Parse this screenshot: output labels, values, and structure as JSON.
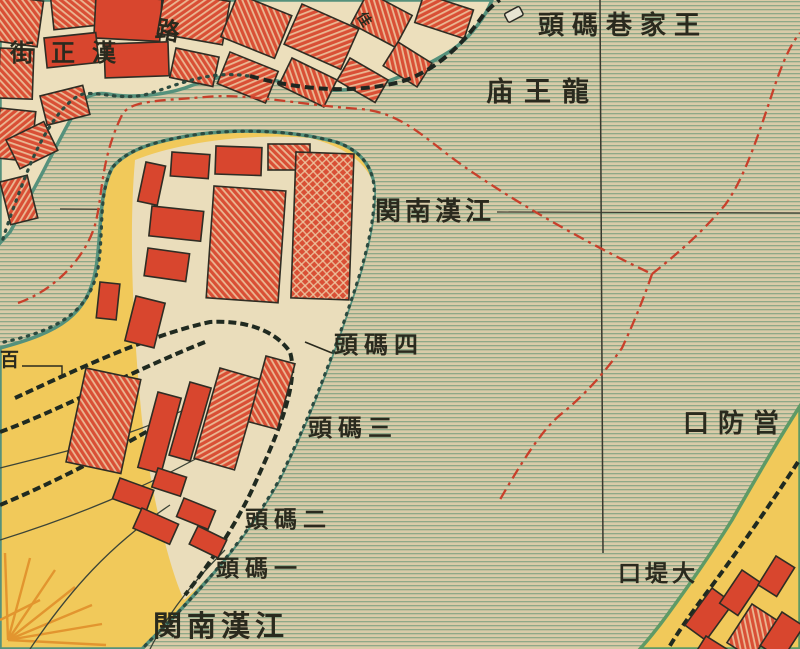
{
  "map": {
    "labels": {
      "wangjiaxiang_wharf": "頭碼巷家王",
      "longwang_temple": "庙王龍",
      "jianghan_nanguan_river": "関南漢江",
      "wharf_4": "頭碼四",
      "wharf_3": "頭碼三",
      "wharf_2": "頭碼二",
      "wharf_1": "頭碼一",
      "jianghan_nanguan_south": "関南漢江",
      "yingfangkou": "口防営",
      "dadikou": "口堤大",
      "hanzheng_street": "街正漢",
      "road_char": "路",
      "street_char": "佳",
      "bai_char": "百"
    },
    "colors": {
      "water_base": "#d9cba8",
      "water_stripe": "#8fa888",
      "land_cream": "#ecdfbc",
      "land_yellow": "#f1c95a",
      "building_red": "#d8462e",
      "boundary_red": "#c8402b",
      "shore_teal": "#55917c",
      "shore_green": "#5f9a66",
      "ink": "#2a2a1e"
    }
  }
}
